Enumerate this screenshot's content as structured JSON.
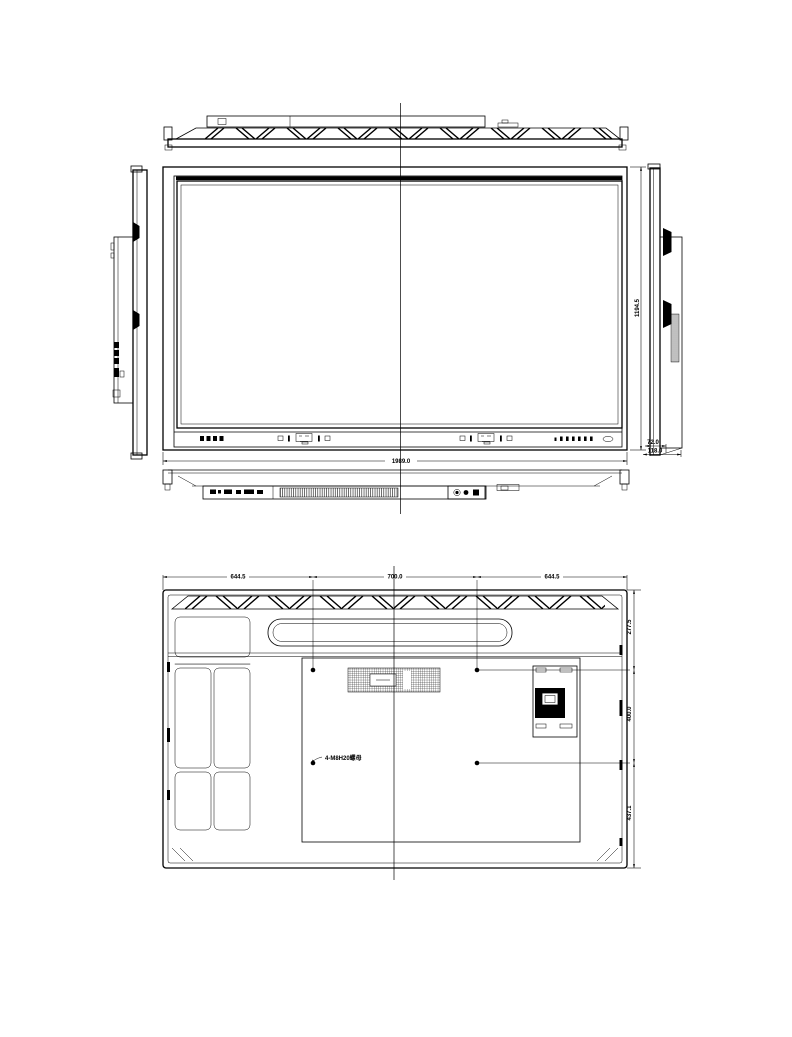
{
  "drawing": {
    "background_color": "#ffffff",
    "line_color": "#000000",
    "dimensions": {
      "front_width": "1989.0",
      "front_height": "1194.5",
      "side_depth_body": "72.0",
      "side_depth_overall": "118.0",
      "rear_top_left": "644.5",
      "rear_top_center": "700.0",
      "rear_top_right": "644.5",
      "rear_right_upper": "277.5",
      "rear_right_middle": "400.0",
      "rear_right_lower": "437.1"
    },
    "annotations": {
      "vesa_note": "4-M8H20螺母"
    }
  }
}
